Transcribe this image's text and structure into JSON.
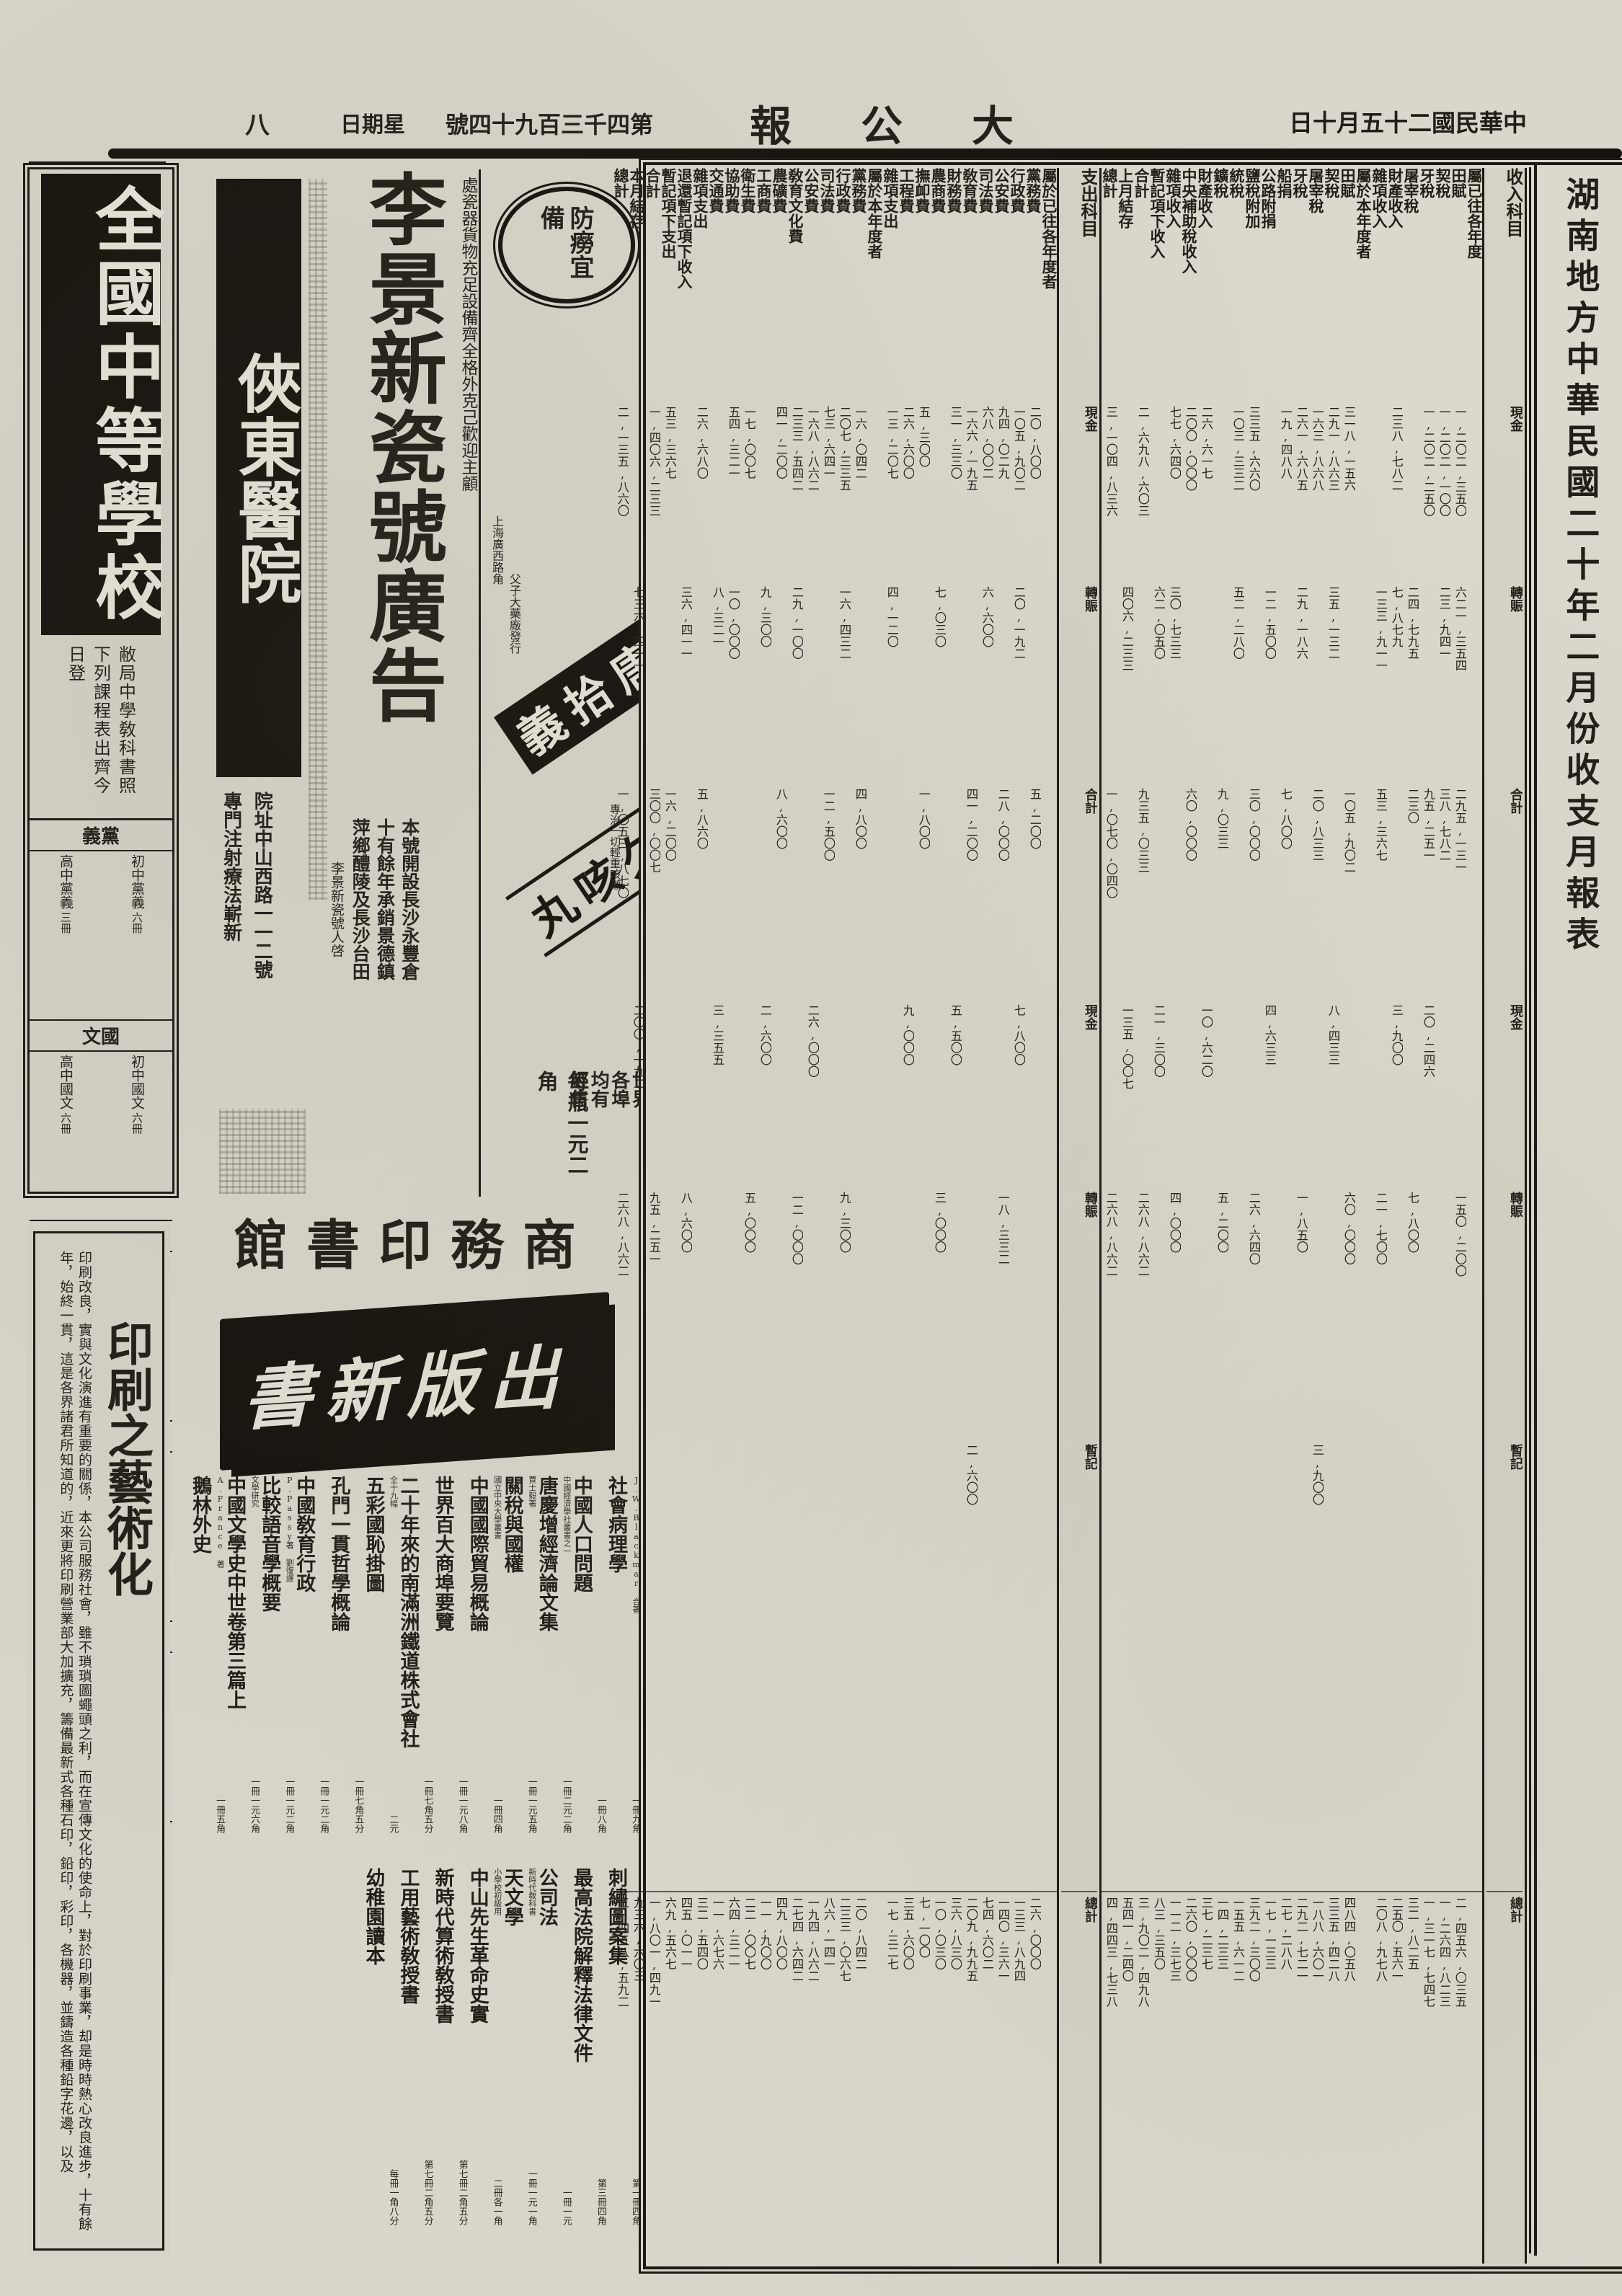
{
  "masthead": {
    "page_number": "八",
    "weekday": "星期日",
    "issue": "第四千三百九十四號",
    "paper_title": "大公報",
    "date": "中華民國二十五月十日",
    "ink_color": "#1c1914",
    "paper_color": "#d9d6cb"
  },
  "school_ad": {
    "title": "全國中等學校",
    "announce": "敝局中學敎科書照下列課程表出齊今日登",
    "sections": [
      {
        "name": "黨義",
        "rows": [
          {
            "tag": "",
            "course": "初中黨義",
            "vols": "六冊"
          },
          {
            "tag": "",
            "course": "高中黨義",
            "vols": "三冊"
          }
        ]
      },
      {
        "name": "國文",
        "rows": [
          {
            "tag": "",
            "course": "初中國文",
            "vols": "六冊"
          },
          {
            "tag": "",
            "course": "高中國文",
            "vols": "六冊"
          }
        ]
      },
      {
        "name": "歷史",
        "rows": [
          {
            "tag": "分科編制",
            "course": "初中本國史",
            "vols": "四冊"
          },
          {
            "tag": "分科編制",
            "course": "初中外國史",
            "vols": "二冊"
          },
          {
            "tag": "混合編制",
            "course": "初中歷史",
            "vols": "六冊"
          },
          {
            "tag": "",
            "course": "高中本國史",
            "vols": "二冊"
          }
        ]
      },
      {
        "name": "英語",
        "rows": [
          {
            "tag": "",
            "course": "標準英語讀本",
            "vols": "三冊"
          },
          {
            "tag": "",
            "course": "實驗英文讀本",
            "vols": "三冊"
          }
        ]
      },
      {
        "name": "自然",
        "rows": [
          {
            "tag": "混合編制",
            "course": "初中自然科學",
            "vols": "七冊"
          },
          {
            "tag": "分科編制",
            "course": "初中植物學",
            "vols": "一冊"
          }
        ]
      }
    ],
    "footer": "世界書局"
  },
  "article": {
    "title": "印刷之藝術化",
    "body": "印刷改良，實與文化演進有重要的關係，本公司服務社會，雖不瑣瑣圖蠅頭之利，而在宣傳文化的使命上，對於印刷事業，却是時時熱心改良進步，十有餘年，始終一貫，這是各界諸君所知道的，近來更將印刷營業部大加擴充，籌備最新式各種石印，鉛印，彩印，各機器，並鑄造各種鉛字花邊，以及"
  },
  "hospital_ad": {
    "title": "俠東醫院",
    "line1": "院址中山西路一一二號",
    "line2": "專門注射療法嶄新"
  },
  "porcelain_ad": {
    "side_note": "處瓷器貨物充足設備齊全格外克己歡迎主顧",
    "title": "李景新瓷號廣告",
    "body_lines": [
      "本號開設長沙永豐倉",
      "十有餘年承銷景德鎮",
      "萍鄉醴陵及長沙台田"
    ],
    "signature": "李景新瓷號人啓"
  },
  "medicine_ad": {
    "seal": "防癆宜備",
    "side1": "上海廣西路角",
    "side2": "父子大藥廠發行",
    "brand": "唐拾義",
    "product": "久咳丸",
    "claim": "專治一切輕重咳嗽",
    "price": "每瓶一元二角",
    "distribution": "世界各埠均有經售"
  },
  "press_ad": {
    "header": "商務印書館",
    "banner": "出版新書",
    "books": [
      {
        "title": "社會病理學",
        "note": "J.W.Blackmar 合著",
        "price": "一冊九角"
      },
      {
        "title": "中國人口問題",
        "note": "",
        "price": "一冊八角"
      },
      {
        "title": "唐慶增經濟論文集",
        "note": "中國經濟學社叢書之一",
        "price": "一冊二元二角"
      },
      {
        "title": "關稅與國權",
        "note": "賈士毅著",
        "price": "一冊一元五角"
      },
      {
        "title": "中國國際貿易概論",
        "note": "國立中央大學叢書",
        "price": "一冊四角"
      },
      {
        "title": "世界百大商埠要覽",
        "note": "",
        "price": "一冊一元八角"
      },
      {
        "title": "二十年來的南滿洲鐵道株式會社",
        "note": "",
        "price": "一冊七角五分"
      },
      {
        "title": "五彩國恥掛圖",
        "note": "全十九幅",
        "price": "二元"
      },
      {
        "title": "孔門一貫哲學概論",
        "note": "",
        "price": "一冊七角五分"
      },
      {
        "title": "中國敎育行政",
        "note": "",
        "price": "一冊一元二角"
      },
      {
        "title": "比較語音學概要",
        "note": "P.Passy著 劉復譯",
        "price": "一冊一元二角"
      },
      {
        "title": "中國文學史中世卷第三篇上",
        "note": "文學研究",
        "price": "一冊一元六角"
      },
      {
        "title": "鵝林外史",
        "note": "A.France 著",
        "price": "一冊五角"
      },
      {
        "title": "刺繡圖案集",
        "note": "",
        "price": "第一冊四角"
      },
      {
        "title": "最高法院解釋法律文件",
        "note": "",
        "price": "第三冊四角"
      },
      {
        "title": "公司法",
        "note": "",
        "price": "一冊一元"
      },
      {
        "title": "天文學",
        "note": "新時代敎科書",
        "price": "一冊一元一角"
      },
      {
        "title": "中山先生革命史實",
        "note": "小學校初級用",
        "price": "二冊各一角"
      },
      {
        "title": "新時代算術敎授書",
        "note": "",
        "price": "第七冊二角五分"
      },
      {
        "title": "工用藝術敎授書",
        "note": "",
        "price": "第七冊二角五分"
      },
      {
        "title": "幼稚園讀本",
        "note": "",
        "price": "每冊一角八分"
      }
    ]
  },
  "fin_table": {
    "title": "湖南地方中華民國二十年二月份收支月報表",
    "section_labels": [
      "經常門",
      "臨時門",
      "總計"
    ],
    "columns": [
      {
        "h": "收入科目",
        "t": "lab",
        "c": [
          "現金",
          "轉賑",
          "合計",
          "現金",
          "轉賑",
          "暫記",
          "總計"
        ]
      },
      {
        "h": "屬已往各年度",
        "t": "mark",
        "c": [
          "",
          "",
          "",
          "",
          "",
          "",
          ""
        ]
      },
      {
        "h": "田賦",
        "t": "num",
        "c": [
          "一,二〇二,三五〇",
          "六二一,三五四",
          "二九五,一三一",
          "",
          "一五〇,二〇〇",
          "",
          "二,四五六,〇三五"
        ]
      },
      {
        "h": "契稅",
        "t": "num",
        "c": [
          "一,二〇二,一〇〇",
          "二三,九四一",
          "三八,七八二",
          "",
          "",
          "",
          "一,二六四,八二三"
        ]
      },
      {
        "h": "牙稅",
        "t": "num",
        "c": [
          "一,二〇二,二五〇",
          "",
          "九五,二五一",
          "二〇,二四六",
          "",
          "",
          "一,三一七,七四七"
        ]
      },
      {
        "h": "屠宰稅",
        "t": "num",
        "c": [
          "",
          "二四,七九五",
          "二三〇",
          "",
          "七,八〇〇",
          "",
          "三二,八二五"
        ]
      },
      {
        "h": "財產收入",
        "t": "num",
        "c": [
          "二三八,七八二",
          "七,八七九",
          "",
          "三,九〇〇",
          "",
          "",
          "二五〇,五六一"
        ]
      },
      {
        "h": "雜項收入",
        "t": "num",
        "c": [
          "",
          "一三三,九一一",
          "五三,三六七",
          "",
          "二一,七〇〇",
          "",
          "二〇八,九七八"
        ]
      },
      {
        "h": "屬於本年度者",
        "t": "mark",
        "c": [
          "",
          "",
          "",
          "",
          "",
          "",
          ""
        ]
      },
      {
        "h": "田賦",
        "t": "num",
        "c": [
          "三一八,一五六",
          "",
          "一〇五,九〇二",
          "",
          "六〇,〇〇〇",
          "",
          "四八四,〇五八"
        ]
      },
      {
        "h": "契稅",
        "t": "num",
        "c": [
          "二九一,八六三",
          "三五,一三二",
          "",
          "八,四三三",
          "",
          "",
          "三三五,四二八"
        ]
      },
      {
        "h": "屠宰稅",
        "t": "num",
        "c": [
          "一六三,八六八",
          "",
          "二〇,八三三",
          "",
          "",
          "三,九〇〇",
          "一八八,六〇一"
        ]
      },
      {
        "h": "牙稅",
        "t": "num",
        "c": [
          "二六一,六八五",
          "二九,一八六",
          "",
          "",
          "一,八五〇",
          "",
          "二九二,七二一"
        ]
      },
      {
        "h": "船捐",
        "t": "num",
        "c": [
          "一九,四八八",
          "",
          "七,八〇〇",
          "",
          "",
          "",
          "二七,二八八"
        ]
      },
      {
        "h": "公路附捐",
        "t": "num",
        "c": [
          "",
          "一二,五〇〇",
          "",
          "四,六三三",
          "",
          "",
          "一七,一三三"
        ]
      },
      {
        "h": "鹽稅附加",
        "t": "num",
        "c": [
          "三三五,六六〇",
          "",
          "三〇,〇〇〇",
          "",
          "二六,六四〇",
          "",
          "三九二,三〇〇"
        ]
      },
      {
        "h": "統稅",
        "t": "num",
        "c": [
          "一〇三,三三二",
          "五二,二八〇",
          "",
          "",
          "",
          "",
          "一五五,六一二"
        ]
      },
      {
        "h": "鑛稅",
        "t": "num",
        "c": [
          "",
          "",
          "九,〇三三",
          "",
          "五,二〇〇",
          "",
          "一四,二三三"
        ]
      },
      {
        "h": "財產收入",
        "t": "num",
        "c": [
          "二六,六一七",
          "",
          "",
          "一〇,六二〇",
          "",
          "",
          "三七,二三七"
        ]
      },
      {
        "h": "中央補助稅收入",
        "t": "num",
        "c": [
          "二〇〇,〇〇〇",
          "",
          "六〇,〇〇〇",
          "",
          "",
          "",
          "二六〇,〇〇〇"
        ]
      },
      {
        "h": "雜項收入",
        "t": "num",
        "c": [
          "七七,六四〇",
          "三〇,七三三",
          "",
          "",
          "四,〇〇〇",
          "",
          "一一二,三七三"
        ]
      },
      {
        "h": "暫記項下收入",
        "t": "num",
        "c": [
          "",
          "六二,〇五〇",
          "",
          "二一,三〇〇",
          "",
          "",
          "八三,三五〇"
        ]
      },
      {
        "h": "合計",
        "t": "num",
        "c": [
          "二,六九八,六〇三",
          "",
          "九三五,〇三三",
          "",
          "二六八,八六二",
          "",
          "三,九〇二,四九八"
        ]
      },
      {
        "h": "上月結存",
        "t": "num",
        "c": [
          "",
          "四〇六,二三三",
          "",
          "一三五,〇〇七",
          "",
          "",
          "五四一,二四〇"
        ]
      },
      {
        "h": "總計",
        "t": "num",
        "c": [
          "三,一〇四,八三六",
          "",
          "一,〇七〇,〇四〇",
          "",
          "二六八,八六二",
          "",
          "四,四四三,七三八"
        ]
      },
      {
        "h": "支出科目",
        "t": "lab",
        "c": [
          "現金",
          "轉賑",
          "合計",
          "現金",
          "轉賑",
          "暫記",
          "總計"
        ]
      },
      {
        "h": "屬於已往各年度者",
        "t": "mark",
        "c": [
          "",
          "",
          "",
          "",
          "",
          "",
          ""
        ]
      },
      {
        "h": "黨務費",
        "t": "num",
        "c": [
          "二〇,八〇〇",
          "",
          "五,二〇〇",
          "",
          "",
          "",
          "二六,〇〇〇"
        ]
      },
      {
        "h": "行政費",
        "t": "num",
        "c": [
          "一〇五,九〇二",
          "二〇,一九二",
          "",
          "七,八〇〇",
          "",
          "",
          "一三三,八九四"
        ]
      },
      {
        "h": "公安費",
        "t": "num",
        "c": [
          "九四,〇二九",
          "",
          "二八,〇〇〇",
          "",
          "一八,三三二",
          "",
          "一四〇,三六一"
        ]
      },
      {
        "h": "司法費",
        "t": "num",
        "c": [
          "六八,〇〇二",
          "六,六〇〇",
          "",
          "",
          "",
          "",
          "七四,六〇二"
        ]
      },
      {
        "h": "敎育費",
        "t": "num",
        "c": [
          "一六六,一九五",
          "",
          "四一,二〇〇",
          "",
          "",
          "二,六〇〇",
          "二〇九,九九五"
        ]
      },
      {
        "h": "財務費",
        "t": "num",
        "c": [
          "三一,三三〇",
          "",
          "",
          "五,五〇〇",
          "",
          "",
          "三六,八三〇"
        ]
      },
      {
        "h": "農商費",
        "t": "num",
        "c": [
          "",
          "七,〇三〇",
          "",
          "",
          "三,〇〇〇",
          "",
          "一〇,〇三〇"
        ]
      },
      {
        "h": "撫卹費",
        "t": "num",
        "c": [
          "五,三〇〇",
          "",
          "一,八〇〇",
          "",
          "",
          "",
          "七,一〇〇"
        ]
      },
      {
        "h": "工程費",
        "t": "num",
        "c": [
          "二六,六〇〇",
          "",
          "",
          "九,〇〇〇",
          "",
          "",
          "三五,六〇〇"
        ]
      },
      {
        "h": "雜項支出",
        "t": "num",
        "c": [
          "一三,二〇七",
          "四,一二〇",
          "",
          "",
          "",
          "",
          "一七,三二七"
        ]
      },
      {
        "h": "屬於本年度者",
        "t": "mark",
        "c": [
          "",
          "",
          "",
          "",
          "",
          "",
          ""
        ]
      },
      {
        "h": "黨務費",
        "t": "num",
        "c": [
          "一六,〇四二",
          "",
          "四,八〇〇",
          "",
          "",
          "",
          "二〇,八四二"
        ]
      },
      {
        "h": "行政費",
        "t": "num",
        "c": [
          "二〇七,三三五",
          "一六,四三二",
          "",
          "",
          "九,三〇〇",
          "",
          "二三三,〇六七"
        ]
      },
      {
        "h": "司法費",
        "t": "num",
        "c": [
          "七三,六四一",
          "",
          "一二,五〇〇",
          "",
          "",
          "",
          "八六,一四一"
        ]
      },
      {
        "h": "公安費",
        "t": "num",
        "c": [
          "一六八,八六二",
          "",
          "",
          "二六,〇〇〇",
          "",
          "",
          "一九四,八六二"
        ]
      },
      {
        "h": "敎育文化費",
        "t": "num",
        "c": [
          "二三三,五四二",
          "二九,一〇〇",
          "",
          "",
          "一二,〇〇〇",
          "",
          "二七四,六四二"
        ]
      },
      {
        "h": "農礦費",
        "t": "num",
        "c": [
          "四一,二〇〇",
          "",
          "八,六〇〇",
          "",
          "",
          "",
          "四九,八〇〇"
        ]
      },
      {
        "h": "工商費",
        "t": "num",
        "c": [
          "",
          "九,三〇〇",
          "",
          "二,六〇〇",
          "",
          "",
          "一一,九〇〇"
        ]
      },
      {
        "h": "衛生費",
        "t": "num",
        "c": [
          "一七,〇〇七",
          "",
          "",
          "",
          "五,〇〇〇",
          "",
          "二二,〇〇七"
        ]
      },
      {
        "h": "協助費",
        "t": "num",
        "c": [
          "五四,三二一",
          "一〇,〇〇〇",
          "",
          "",
          "",
          "",
          "六四,三二一"
        ]
      },
      {
        "h": "交通費",
        "t": "num",
        "c": [
          "",
          "八,三二一",
          "",
          "三,三五五",
          "",
          "",
          "一一,六七六"
        ]
      },
      {
        "h": "雜項支出",
        "t": "num",
        "c": [
          "二六,六八〇",
          "",
          "五,八六〇",
          "",
          "",
          "",
          "三二,五四〇"
        ]
      },
      {
        "h": "退還暫記項下收入",
        "t": "num",
        "c": [
          "",
          "三六,四一一",
          "",
          "",
          "八,六〇〇",
          "",
          "四五,〇一一"
        ]
      },
      {
        "h": "暫記項下支出",
        "t": "num",
        "c": [
          "五三,三六七",
          "",
          "一六,二〇〇",
          "",
          "",
          "",
          "六九,五六七"
        ]
      },
      {
        "h": "合計",
        "t": "num",
        "c": [
          "一,四〇六,二三三",
          "",
          "三〇〇,〇〇七",
          "",
          "九五,二五一",
          "",
          "一,八〇一,四九一"
        ]
      },
      {
        "h": "本月結存",
        "t": "num",
        "c": [
          "",
          "七三六,四一一",
          "",
          "二〇〇,一九二",
          "",
          "",
          "九三六,六〇三"
        ]
      },
      {
        "h": "總計",
        "t": "num",
        "c": [
          "二,一三五,八六〇",
          "",
          "一,〇五三,八七〇",
          "",
          "二六八,八六二",
          "",
          "三,四五八,五九二"
        ]
      }
    ]
  }
}
